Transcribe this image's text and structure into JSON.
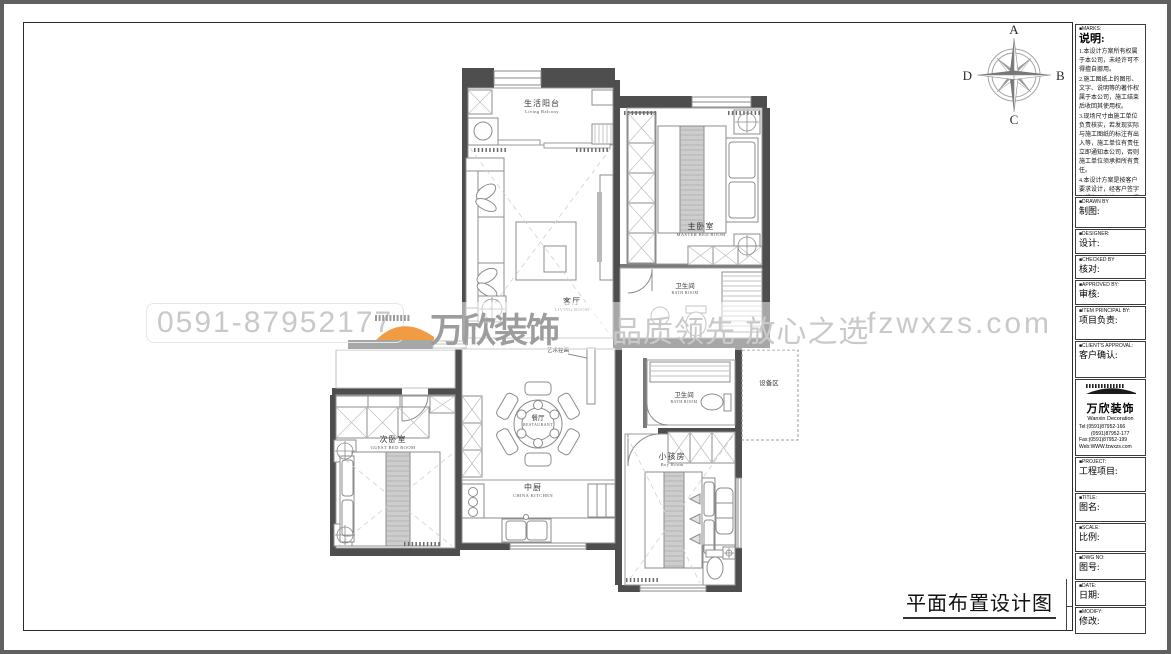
{
  "compass": {
    "north": "A",
    "east": "B",
    "south": "C",
    "west": "D"
  },
  "watermark": {
    "phone": "0591-87952177",
    "brand": "万欣装饰",
    "slogan": "品质领先 放心之选",
    "url": "fzwxzs.com"
  },
  "rooms": {
    "living_balcony": {
      "zh": "生活阳台",
      "en": "Living Balcony"
    },
    "master_bedroom": {
      "zh": "主卧室",
      "en": "MASTER BED ROOM"
    },
    "living_room": {
      "zh": "客厅",
      "en": "LIVING ROOM"
    },
    "bath_room_upper": {
      "zh": "卫生间",
      "en": "BATH ROOM"
    },
    "bath_room_lower": {
      "zh": "卫生间",
      "en": "BATH ROOM"
    },
    "equipment_area": {
      "zh": "设备区"
    },
    "restaurant": {
      "zh": "餐厅",
      "en": "RESTAURANT"
    },
    "guest_bedroom": {
      "zh": "次卧室",
      "en": "GUEST BED ROOM"
    },
    "kitchen": {
      "zh": "中厨",
      "en": "CHINA KITCHEN"
    },
    "kids_room": {
      "zh": "小孩房",
      "en": "Boy Room"
    },
    "art_wall": {
      "zh": "艺术挂画"
    }
  },
  "titleblock": {
    "marks": {
      "tag": "■MARKS:",
      "zh": "说明:",
      "items": [
        "1.本设计方案所有权属于本公司，未经许可不得擅自挪用。",
        "2.施工图纸上的图形、文字、说明等的著作权属于本公司，施工结束后收回其使用权。",
        "3.现场尺寸由施工单位负责核实，若发现实际与施工图纸的标注有出入等，施工单位有责任立即通知本公司，否则施工单位须承担所有责任。",
        "4.本设计方案是按客户要求设计，经客户签字即视为同意认可，不得随意更改。"
      ]
    },
    "fields": [
      {
        "tag": "■DRAWN BY",
        "zh": "制图:"
      },
      {
        "tag": "■DESIGNER:",
        "zh": "设计:"
      },
      {
        "tag": "■CHECKED BY",
        "zh": "核对:"
      },
      {
        "tag": "■APPROVED BY:",
        "zh": "审核:"
      },
      {
        "tag": "■ITEM PRINCIPAL BY:",
        "zh": "项目负责:"
      },
      {
        "tag": "■CLIENT'S APPROVAL:",
        "zh": "客户确认:"
      }
    ],
    "company": {
      "name_zh": "万欣装饰",
      "name_en": "Wanxin Decoration",
      "tel1": "Tel:(0591)87952-166",
      "tel2": "(0591)87952-177",
      "fax": "Fax:(0591)87952-199",
      "web": "Web:WWW.fzwxzs.com"
    },
    "fields2": [
      {
        "tag": "■PROJECT:",
        "zh": "工程项目:"
      },
      {
        "tag": "■TITLE:",
        "zh": "图名:"
      },
      {
        "tag": "■SCALE:",
        "zh": "比例:"
      },
      {
        "tag": "■DWG NO:",
        "zh": "图号:"
      },
      {
        "tag": "■DATE:",
        "zh": "日期:"
      },
      {
        "tag": "■MODIFY:",
        "zh": "修改:"
      }
    ]
  },
  "footer": {
    "drawing_title": "平面布置设计图"
  }
}
